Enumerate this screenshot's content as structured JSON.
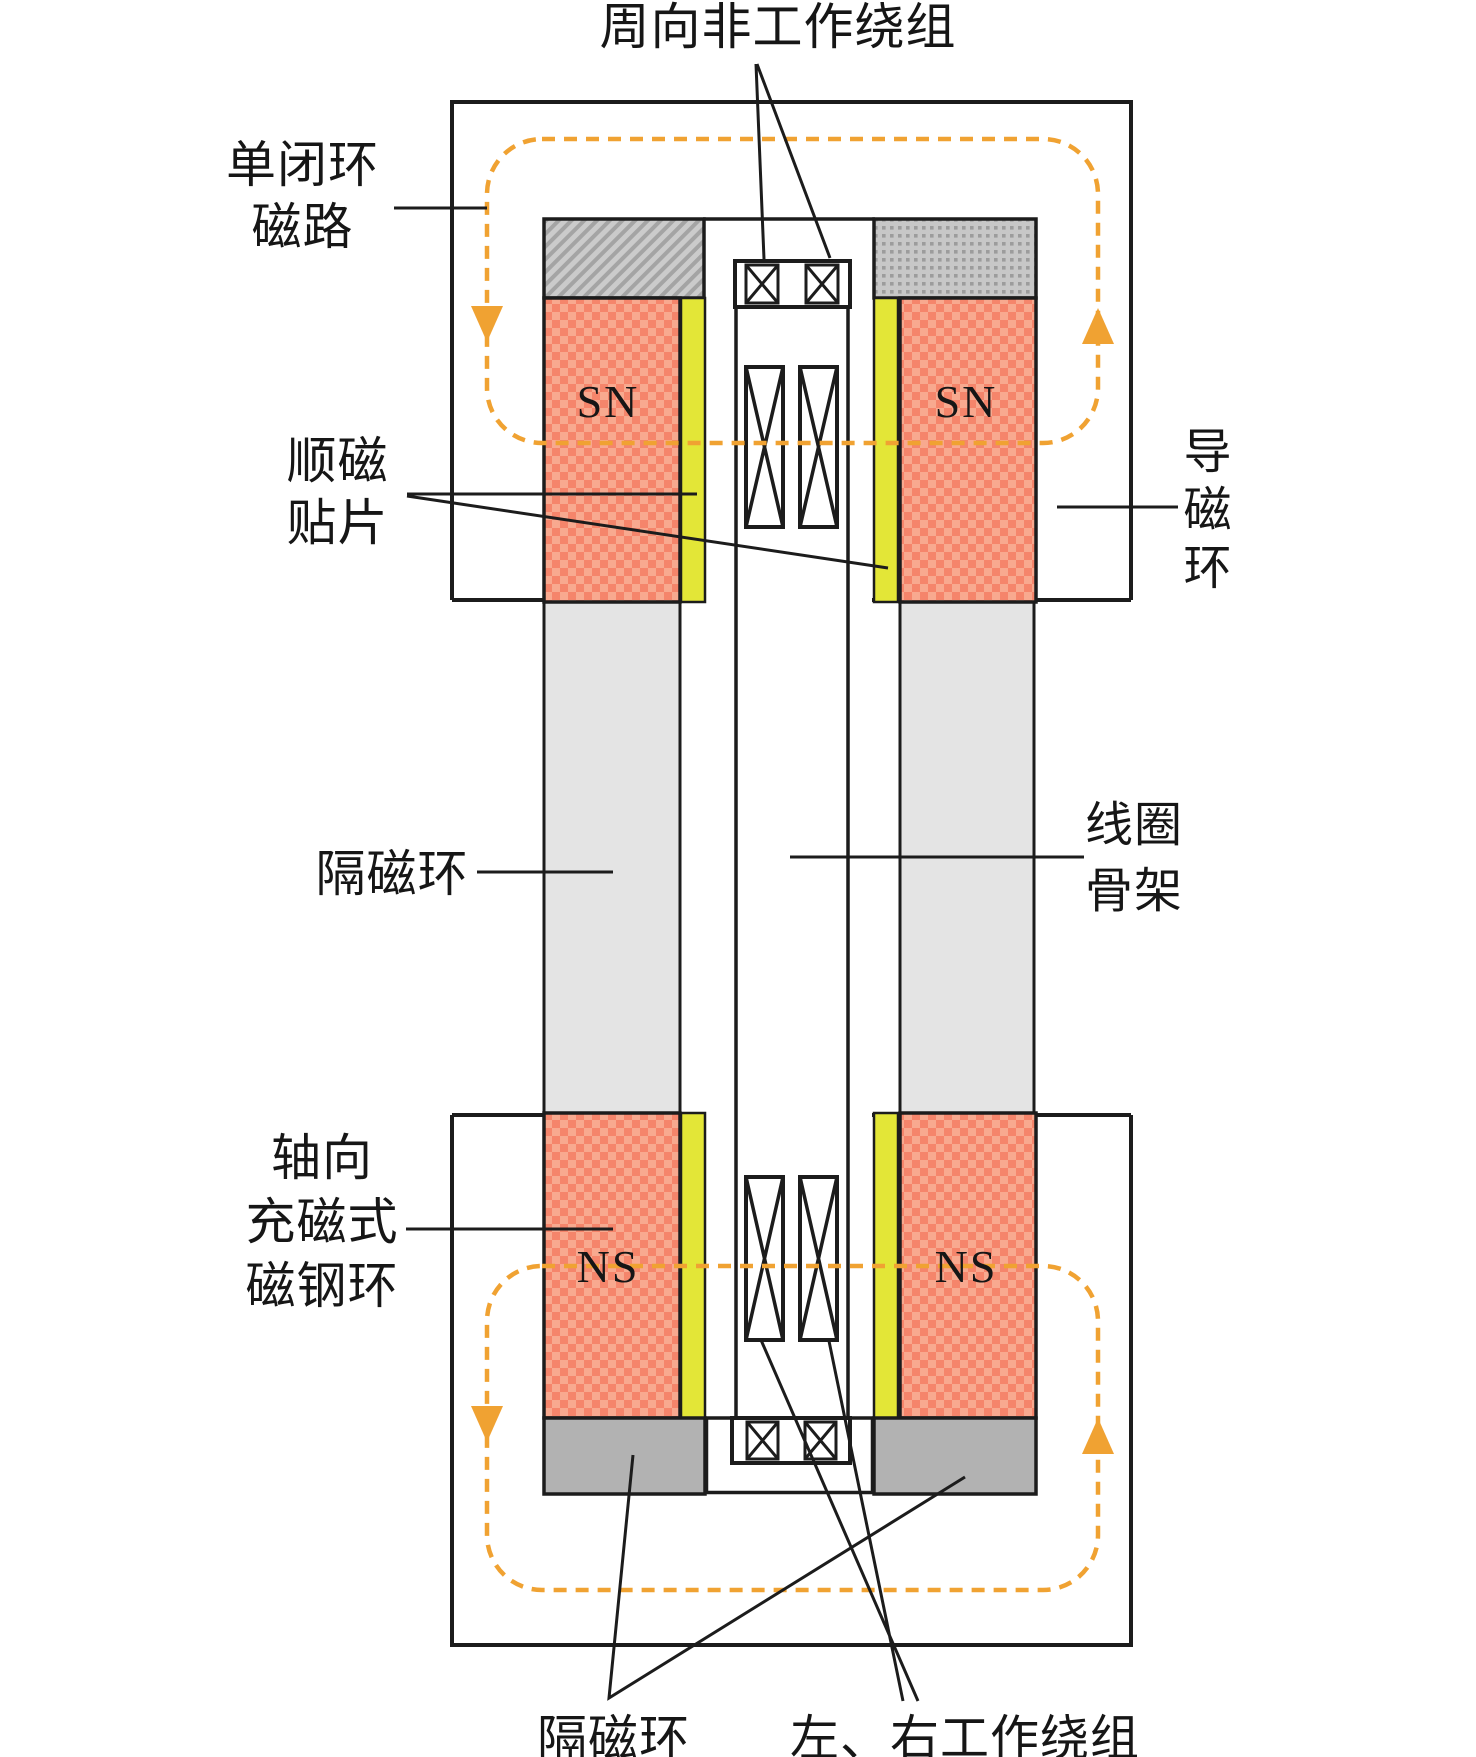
{
  "labels": {
    "circumferential_nonworking_winding": "周向非工作绕组",
    "single_closed_loop_magnetic_circuit": "单闭环\n磁路",
    "paramagnetic_patch": "顺磁\n贴片",
    "flux_conducting_ring": "导\n磁\n环",
    "isolation_ring_middle": "隔磁环",
    "coil_bobbin": "线圈\n骨架",
    "axially_magnetized_magnet_ring": "轴向\n充磁式\n磁钢环",
    "isolation_ring_bottom": "隔磁环",
    "left_right_working_windings": "左、右工作绕组"
  },
  "magnet_polarity": {
    "top_left": "SN",
    "top_right": "SN",
    "bottom_left": "NS",
    "bottom_right": "NS"
  },
  "colors": {
    "magnet_salmon": "#F5856B",
    "magnet_salmon_light": "#F8A98F",
    "paramagnetic_yellow": "#E3E637",
    "flux_path_orange": "#F0A232",
    "isolation_gray_light": "#E4E4E4",
    "block_gray": "#B2B2B2",
    "hatch_gray": "#CBCBCB",
    "line_black": "#1C1C1C"
  }
}
